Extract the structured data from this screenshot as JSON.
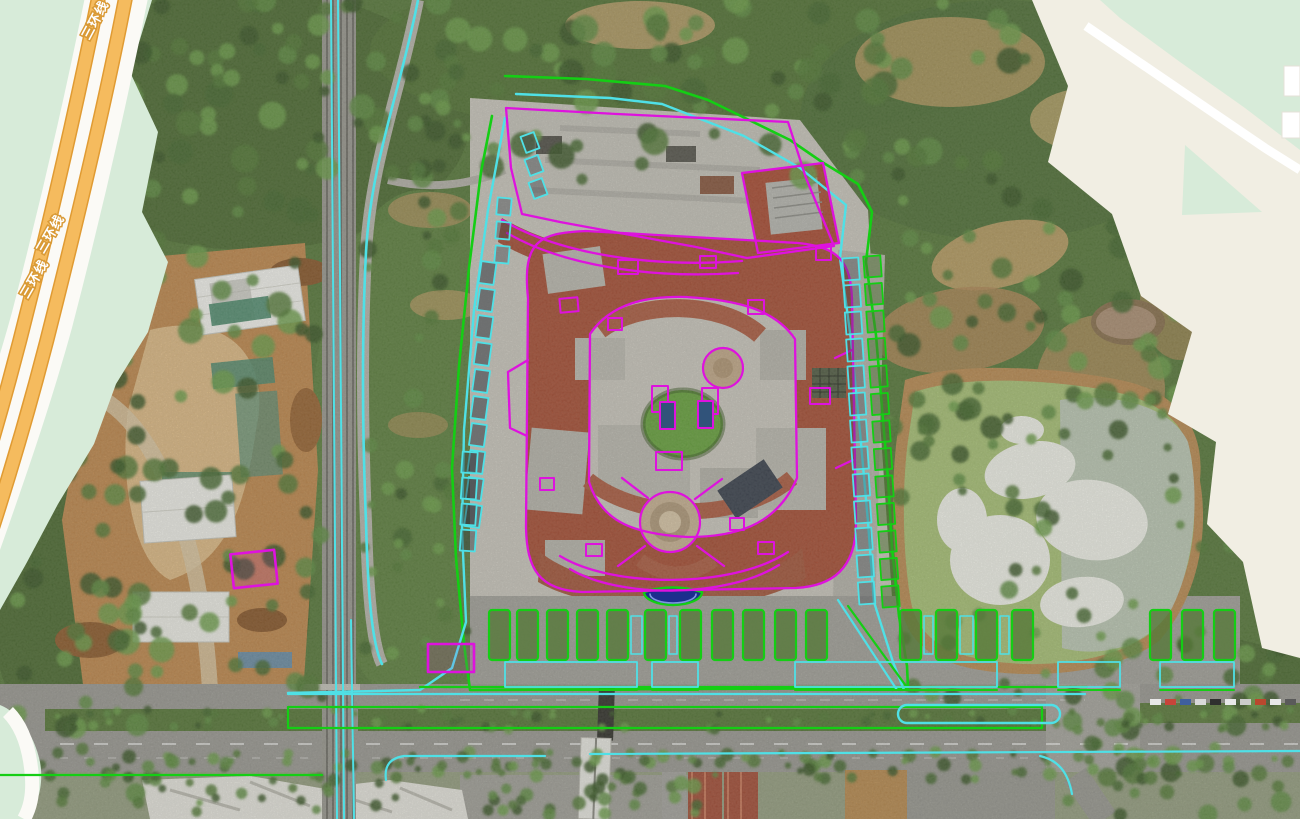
{
  "basemap": {
    "road_name": "三环线",
    "road_labels": [
      {
        "text": "三环线",
        "x": 99,
        "y": 22,
        "rot": -62
      },
      {
        "text": "三环线",
        "x": 54,
        "y": 236,
        "rot": -60
      },
      {
        "text": "三环线",
        "x": 38,
        "y": 281,
        "rot": -60
      }
    ]
  },
  "colors": {
    "boundary_green": "#14ce14",
    "annotation_cyan": "#4fe0e6",
    "annotation_magenta": "#de12de",
    "basemap_bg": "#f1eee3",
    "basemap_green": "#d7ebd9",
    "basemap_road_orange": "#f5bb5e",
    "basemap_road_casing": "#e09b33",
    "pond_water": "#a9c278",
    "pond_white": "#f1f2ea",
    "fountain_blue": "#1c2e8e"
  },
  "overlays": {
    "site_boundary": "505,76 586,79 665,86 708,100 745,118 790,140 822,162 858,184 872,212 866,262 876,335 882,408 888,478 892,548 899,616 907,666 908,688 470,690 464,644 456,558 452,468 459,366 469,268 481,172 492,116",
    "inner_cyan": "516,94 610,98 662,104 744,136 800,168 846,205 840,258 851,340 860,432 868,522 874,602 893,662 904,690",
    "west_cyan": "505,118 488,210 474,310 464,430 462,530 466,622 452,668 420,690 288,693",
    "west_road_cyan": "M418,0 C400,92 371,162 366,252 C362,332 362,422 366,522 C368,602 373,646 382,664",
    "rail_cyan_x": [
      331,
      338
    ],
    "rail_cyan_x2": 351,
    "frontage_cyan": [
      288,
      694,
      1085,
      694
    ],
    "frontage_green": [
      420,
      687,
      1087,
      687
    ],
    "median_rect": [
      288,
      707,
      754,
      21
    ],
    "bus_capsule": [
      898,
      705,
      162,
      18
    ],
    "south_cyan": "M386,780 C384,766 390,758 404,756 L545,756 M590,754 L1300,751",
    "south_cyan_branch": "M1040,756 C1058,760 1068,772 1072,794",
    "south_green": [
      0,
      775,
      322,
      775
    ],
    "diag_green": "M848,606 L906,686",
    "diag_cyan": "M838,600 L897,690",
    "fountain": {
      "cx": 673,
      "cy": 592,
      "rx": 29,
      "ry": 13
    }
  },
  "magenta": {
    "paths": [
      "M506,108 L617,114 L788,122 L806,178 L834,246 L747,258 L696,247 L636,236 L560,222 L522,214 L511,168 Z",
      "M502,220 C560,254 650,268 742,261",
      "M507,233 C562,265 648,279 738,273",
      "M742,173 L823,163 L839,243 L758,253 Z",
      "M528,298 C522,240 540,233 586,231 L798,243 C839,247 851,262 852,300 L856,520 C857,570 831,586 796,588 L582,592 C539,590 527,569 526,528 Z",
      "M590,334 C612,302 649,296 686,297 C741,300 776,311 795,339 L797,478 C776,528 731,537 688,537 C630,534 601,520 589,482 Z",
      "M560,556 C612,588 732,589 788,552",
      "M570,569 C618,598 725,599 779,565",
      "M648,498 L622,478 M695,499 L722,479 M645,546 L618,566 M697,546 L724,566",
      "M528,360 L508,372 L510,428 L527,436",
      "M852,350 L835,358 M853,460 L836,468"
    ],
    "rects": [
      [
        560,
        298,
        18,
        14,
        -5
      ],
      [
        618,
        260,
        20,
        14,
        0
      ],
      [
        700,
        256,
        16,
        12,
        0
      ],
      [
        748,
        300,
        16,
        14,
        0
      ],
      [
        810,
        388,
        20,
        16,
        0
      ],
      [
        816,
        246,
        15,
        14,
        0
      ],
      [
        586,
        544,
        16,
        12,
        0
      ],
      [
        758,
        542,
        16,
        12,
        0
      ],
      [
        540,
        478,
        14,
        12,
        0
      ],
      [
        652,
        386,
        16,
        26,
        0
      ],
      [
        702,
        388,
        16,
        26,
        0
      ],
      [
        656,
        452,
        26,
        18,
        0
      ],
      [
        608,
        318,
        14,
        12,
        0
      ],
      [
        730,
        518,
        14,
        12,
        0
      ],
      [
        660,
        402,
        15,
        27,
        0,
        "#31537a"
      ],
      [
        698,
        401,
        15,
        27,
        0,
        "#31537a"
      ]
    ],
    "circles": [
      [
        670,
        522,
        30
      ],
      [
        723,
        368,
        20
      ]
    ],
    "site_boxes": [
      [
        232,
        552,
        44,
        34,
        -6
      ],
      [
        428,
        644,
        46,
        28,
        0
      ]
    ]
  },
  "stalls": {
    "columns": [
      {
        "x": 480,
        "y": 262,
        "step": 27,
        "count": 10,
        "w": 15,
        "h": 22,
        "dx": -1.6,
        "rot": 8,
        "color": "cyan",
        "fill": "#343b42",
        "fo": 0.55
      },
      {
        "x": 462,
        "y": 452,
        "step": 26,
        "count": 4,
        "w": 15,
        "h": 21,
        "dx": -0.5,
        "rot": 4,
        "color": "cyan",
        "fill": "#343b42",
        "fo": 0.45
      },
      {
        "x": 523,
        "y": 134,
        "step": 23,
        "count": 3,
        "w": 14,
        "h": 17,
        "dx": 4,
        "rot": -20,
        "color": "cyan",
        "fill": "#3c4248",
        "fo": 0.4
      },
      {
        "x": 497,
        "y": 198,
        "step": 24,
        "count": 3,
        "w": 14,
        "h": 17,
        "dx": -1,
        "rot": 5,
        "color": "cyan",
        "fill": "#3c4248",
        "fo": 0.4
      },
      {
        "x": 843,
        "y": 258,
        "step": 27,
        "count": 13,
        "w": 16,
        "h": 22,
        "dx": 1.3,
        "rot": -4,
        "color": "cyan",
        "fill": "#40464c",
        "fo": 0.35
      },
      {
        "x": 864,
        "y": 256,
        "step": 27.5,
        "count": 13,
        "w": 17,
        "h": 21,
        "dx": 1.5,
        "rot": -4,
        "color": "green",
        "fill": "#4e7034",
        "fo": 0.5
      }
    ]
  },
  "parking": {
    "islands_x": [
      489,
      517,
      547,
      577,
      607,
      645,
      680,
      712,
      743,
      775,
      806,
      900,
      936,
      976,
      1012,
      1150,
      1182,
      1214
    ],
    "islands_y": 610,
    "island_w": 21,
    "island_h": 50,
    "lower_stalls": [
      [
        505,
        662,
        132,
        25
      ],
      [
        652,
        662,
        46,
        25
      ],
      [
        795,
        662,
        202,
        25
      ],
      [
        1058,
        662,
        62,
        25
      ],
      [
        1160,
        662,
        74,
        25
      ]
    ]
  },
  "cars_row": {
    "y": 699,
    "x0": 1150,
    "step": 15,
    "count": 10,
    "colors": [
      "#e8e8e8",
      "#c7443a",
      "#3f5f9e",
      "#d9d9d9",
      "#2f2f2f",
      "#e8e8e8",
      "#cccccc",
      "#b9482e",
      "#e8e8e8",
      "#5a5a5a"
    ]
  }
}
